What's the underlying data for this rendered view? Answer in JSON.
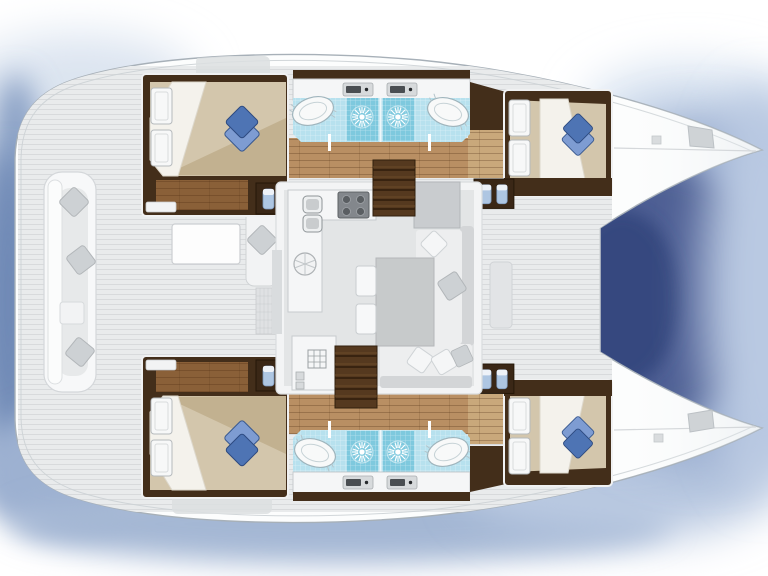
{
  "vessel": {
    "description": "Catamaran yacht interior floor plan, top-down view, bows to the right",
    "hulls": 2,
    "cabins": 4,
    "double_beds": 4,
    "blue_bed_pillows": 4,
    "bathrooms": 4,
    "shower_roses": 4,
    "washbasins": 4,
    "toilet_fixture_pairs": 4,
    "wardrobe_door_pairs": 4,
    "companionway_stairs": 2,
    "bow_deck_hatches": 2
  },
  "saloon": {
    "galley_burners": 4,
    "galley_sinks": 2,
    "round_hob": 1,
    "dinette_table": 1,
    "sofa_shape": "L-shaped",
    "stool_cushions": 2,
    "scatter_pillows": 5
  },
  "cockpit": {
    "location": "aft (left)",
    "bench": "U-shaped transom bench",
    "bench_pillows": 3,
    "coffee_table": 1,
    "chaise_lounge": 1,
    "deck_mat": 1
  },
  "palette": {
    "hull-white": "#fcfdfd",
    "outline": "#a7b0b8",
    "deck": "#e9ebec",
    "deck-stripe": "#d8dadc",
    "wood-dark": "#432e1a",
    "wood-mid": "#b98f63",
    "wood-light": "#c9a87b",
    "wood-steps": "#8a6038",
    "bed-tan": "#d3c6ac",
    "bed-shade": "#c2b190",
    "sheet-white": "#f4f2ec",
    "pillow-blue": "#4e74b4",
    "pillow-blue-light": "#7e9cd2",
    "tile-blue": "#b7e1ee",
    "tile-deep": "#7ec9de",
    "saloon-floor": "#e3e5e6",
    "counter-white": "#f5f6f7",
    "table-gray": "#c7cacb",
    "sofa-seat": "#edeeef",
    "sofa-back": "#d3d5d7",
    "cushion-gray": "#c9cccf",
    "stairs-brown": "#55391f",
    "fixture-blue": "#b2c8e4",
    "stove-gray": "#83878c",
    "shadow-deep": "#3c4f86",
    "shadow-mid": "#8ba2c6",
    "shadow-light": "#c3d1e6"
  }
}
